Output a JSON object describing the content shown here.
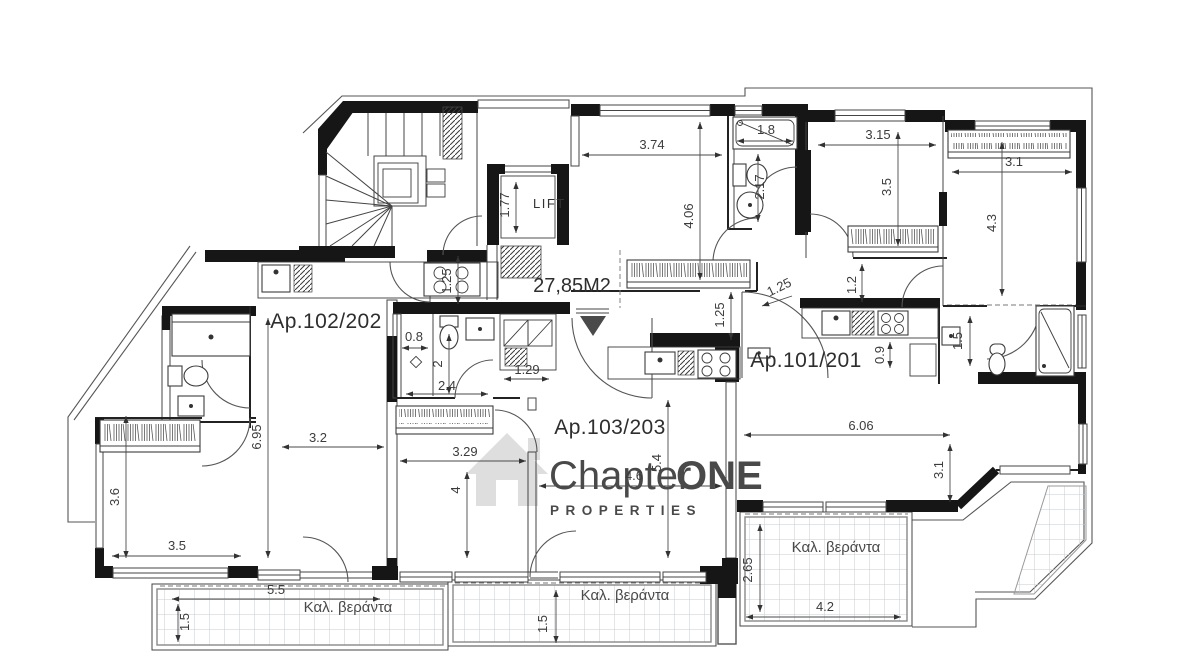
{
  "colors": {
    "wall_poche": "#161616",
    "line": "#3a3a3a",
    "dimension_text": "#3c3c3c",
    "tile_grid": "#c6ccd2",
    "watermark_gray": "#d9d9d9",
    "watermark_accent": "#c4c4c4"
  },
  "watermark": {
    "brand_a": "Chapter",
    "brand_b": "ONE",
    "subtitle": "PROPERTIES"
  },
  "apartments": {
    "a102": "Ap.102/202",
    "a101": "Ap.101/201",
    "a103": "Ap.103/203"
  },
  "hall": {
    "area_label": "27,85M2",
    "lift_label": "LIFT"
  },
  "verandas": {
    "bottom_left": "Καλ. βεράντα",
    "bottom_center": "Καλ. βεράντα",
    "bottom_right": "Καλ. βεράντα"
  },
  "dims": {
    "d374": "3.74",
    "d406": "4.06",
    "d18": "1.8",
    "d217": "2.17",
    "d315": "3.15",
    "d35a": "3.5",
    "d31a": "3.1",
    "d43": "4.3",
    "d12": "1.2",
    "d125a": "1.25",
    "d125b": "1.25",
    "d125c": "1.25",
    "d177": "1.77",
    "d08": "0.8",
    "d2": "2",
    "d24": "2.4",
    "d129": "1.29",
    "d09": "0.9",
    "d15a": "1.5",
    "d695": "6.95",
    "d32": "3.2",
    "d329": "3.29",
    "d4": "4",
    "d46": "4.6",
    "d54": "5.4",
    "d606": "6.06",
    "d31b": "3.1",
    "d36": "3.6",
    "d35b": "3.5",
    "d55": "5.5",
    "d15b": "1.5",
    "d15c": "1.5",
    "d265": "2.65",
    "d42": "4.2"
  }
}
